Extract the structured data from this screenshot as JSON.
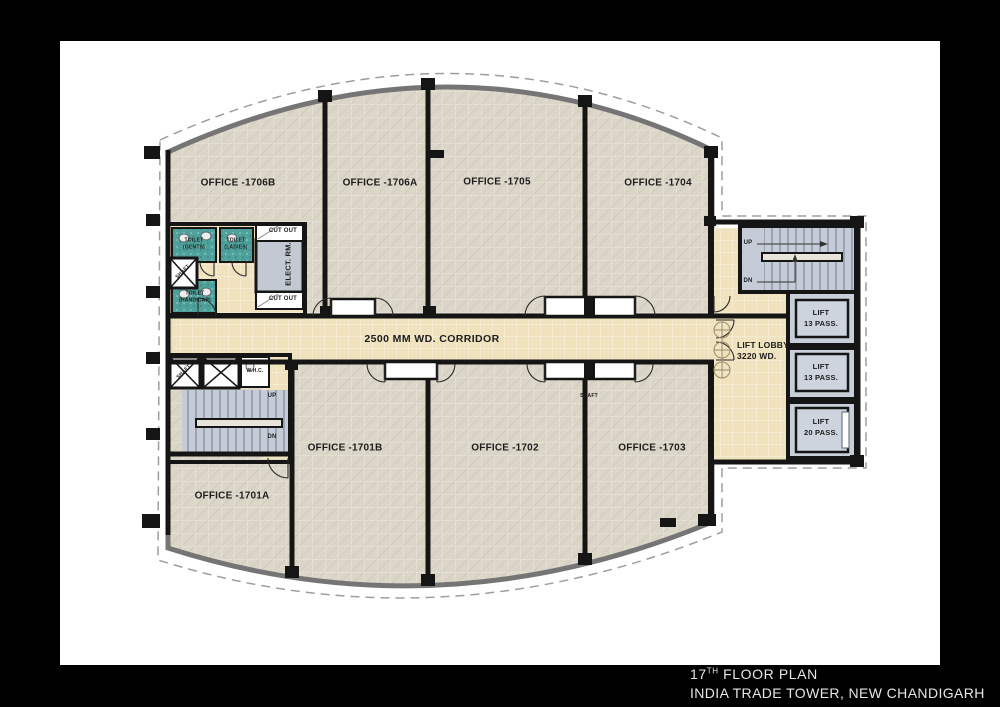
{
  "frame": {
    "bg": "#000000",
    "paper_bg": "#ffffff"
  },
  "title_block": {
    "floor_number": "17",
    "floor_suffix": "TH",
    "floor_rest": " FLOOR PLAN",
    "line2": "INDIA TRADE TOWER, NEW CHANDIGARH"
  },
  "plan": {
    "offices_top": [
      "OFFICE -1706B",
      "OFFICE -1706A",
      "OFFICE -1705",
      "OFFICE -1704"
    ],
    "offices_bottom": [
      "OFFICE -1701A",
      "OFFICE -1701B",
      "OFFICE -1702",
      "OFFICE -1703"
    ],
    "corridor_label": "2500 MM WD. CORRIDOR",
    "lift_lobby_label": "LIFT LOBBY\n3220 WD.",
    "lifts": [
      "LIFT\n13 PASS.",
      "LIFT\n13 PASS.",
      "LIFT\n20 PASS."
    ],
    "stair_up": "UP",
    "stair_dn": "DN",
    "toilet_gents": "TOILET\n(GENTS)",
    "toilet_ladies": "TOILET\n(LADIES)",
    "toilet_handicap": "TOILET\n(HANDICAP)",
    "elect_room": "ELECT. RM.",
    "whc": "W.H.C.",
    "shaft": "SHAFT",
    "cut_out": "CUT OUT"
  },
  "colors": {
    "wall": "#151515",
    "office_floor": "#dbd6c8",
    "corridor_floor": "#f0e2bd",
    "stair_floor": "#c5ccd7",
    "toilet_floor": "#4ea29b",
    "elect_floor": "#c3c9d3",
    "lift_floor": "#c9cfd9",
    "outer_band": "#757575",
    "dashed_line": "#9e9e9e"
  }
}
